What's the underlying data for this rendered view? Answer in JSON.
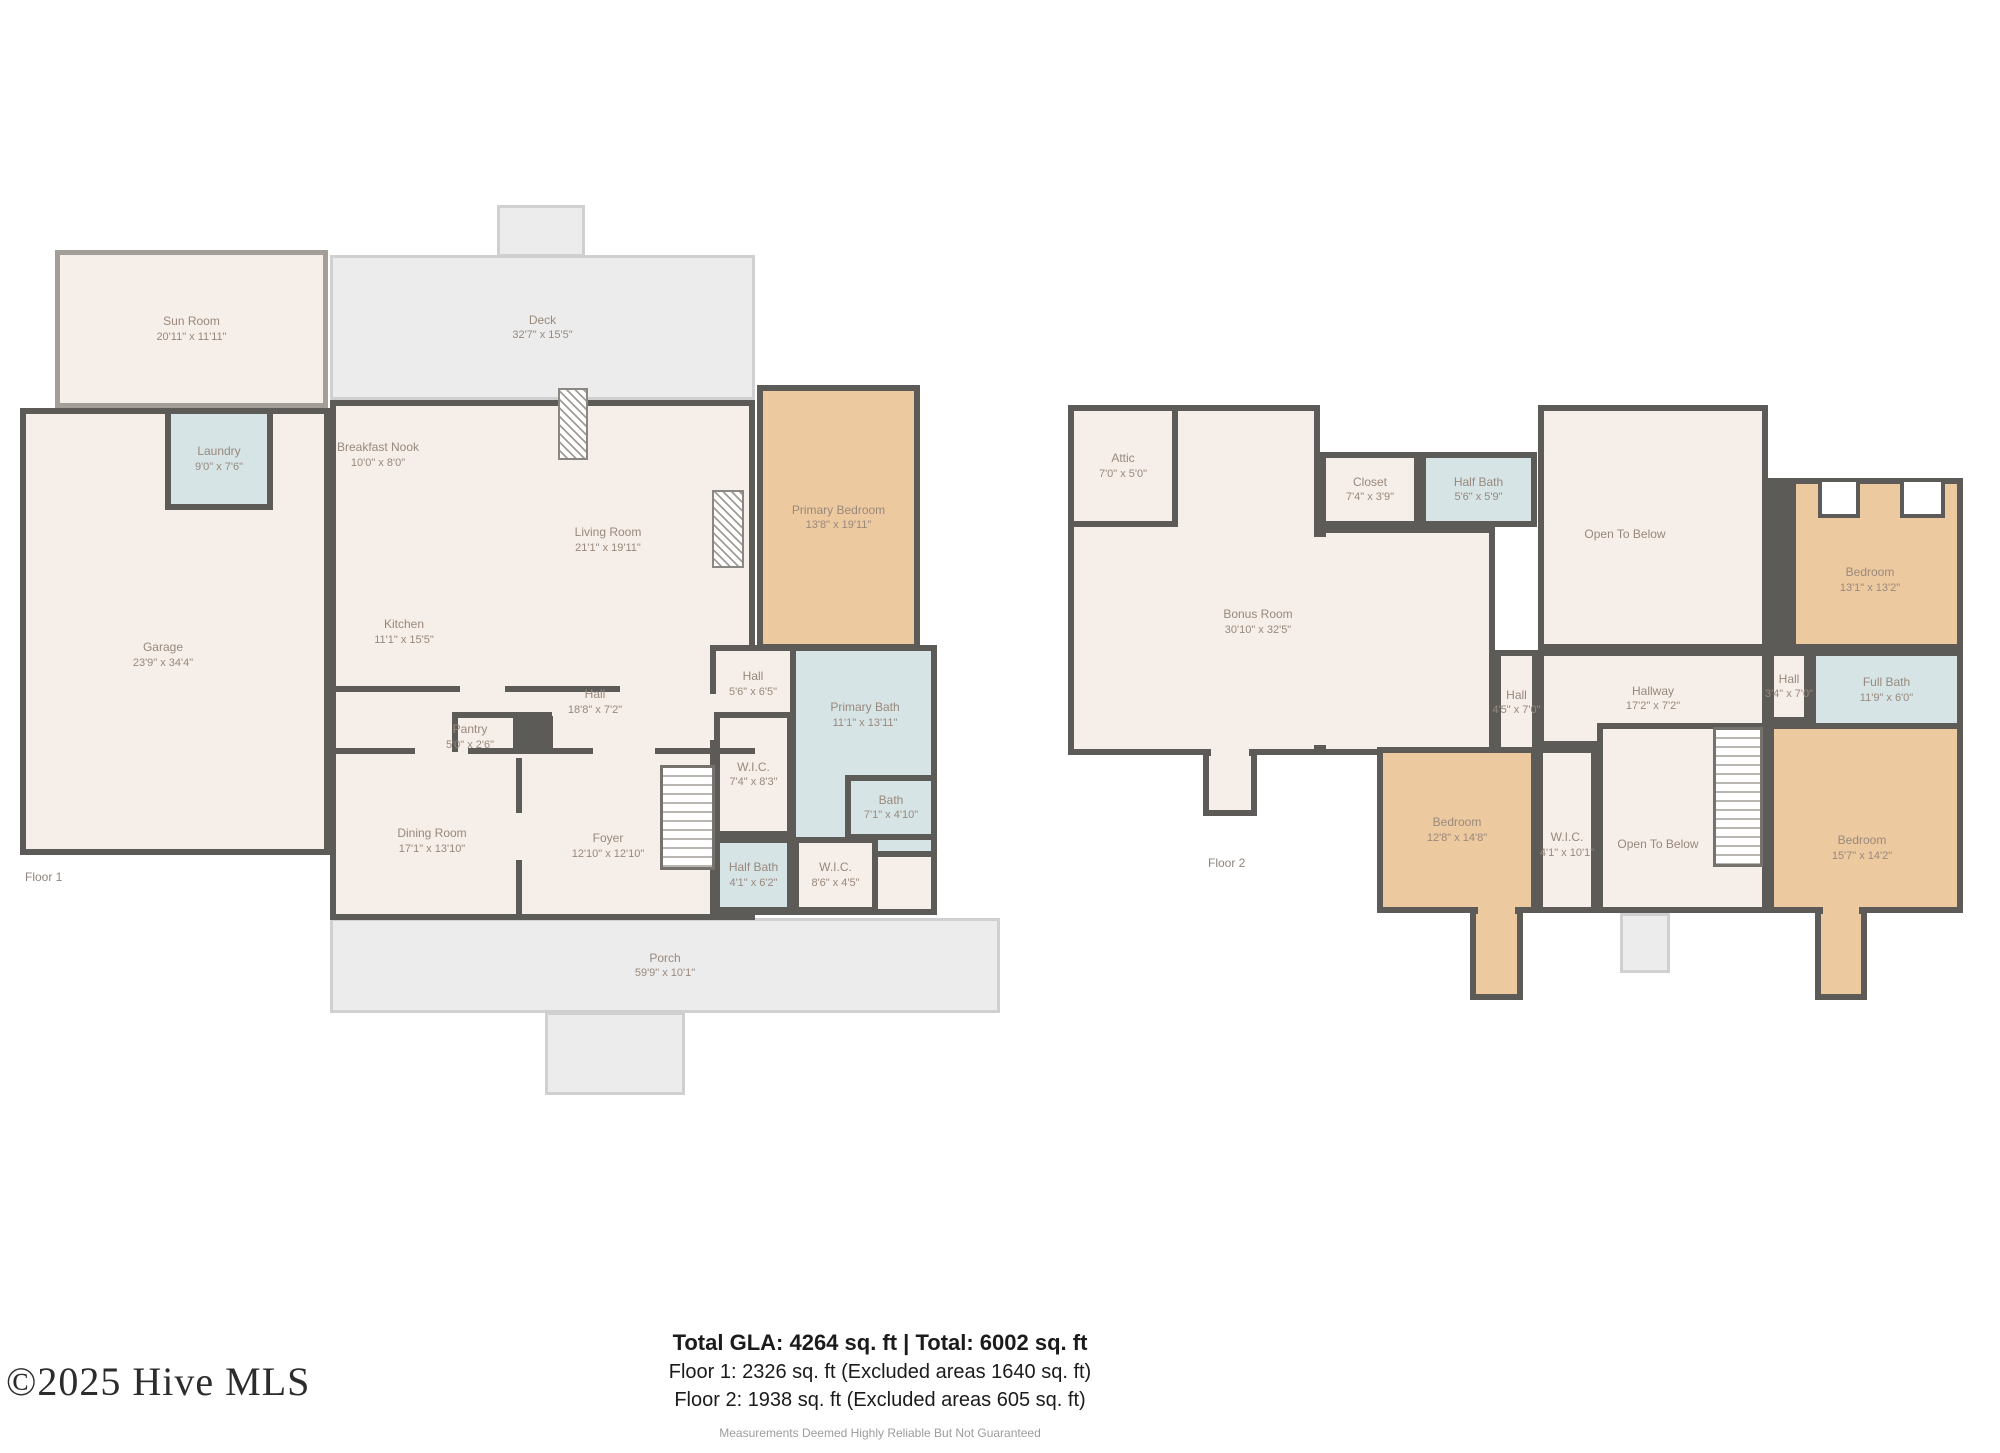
{
  "branding": {
    "copyright": "©2025 Hive MLS"
  },
  "summary": {
    "total": "Total GLA: 4264 sq. ft | Total: 6002 sq. ft",
    "floor1": "Floor 1: 2326 sq. ft (Excluded areas 1640 sq. ft)",
    "floor2": "Floor 2: 1938 sq. ft (Excluded areas 605 sq. ft)",
    "disclaimer": "Measurements Deemed Highly Reliable But Not Guaranteed"
  },
  "palette": {
    "wall": "#5d5b58",
    "room": "#f6eee9",
    "wet": "#d6e4e6",
    "accent": "#edc9a0",
    "outdoor_fill": "#ececec",
    "outdoor_line": "#d0d0d0",
    "label": "#99897c"
  },
  "floors": [
    {
      "tag": "Floor 1",
      "tag_pos": [
        25,
        870
      ],
      "elements": [
        {
          "kind": "outdoor",
          "name": "deck",
          "label": "Deck",
          "dims": "32'7\" x 15'5\"",
          "rect": [
            330,
            255,
            425,
            145
          ]
        },
        {
          "kind": "outdoor",
          "name": "deck-bump",
          "rect": [
            497,
            205,
            88,
            52
          ]
        },
        {
          "kind": "patch",
          "fill": "outdoor",
          "name": "deck-opening",
          "rect": [
            500,
            251,
            82,
            9
          ]
        },
        {
          "kind": "outdoor",
          "name": "porch",
          "label": "Porch",
          "dims": "59'9\" x 10'1\"",
          "rect": [
            330,
            918,
            670,
            95
          ]
        },
        {
          "kind": "outdoor",
          "name": "porch-steps",
          "rect": [
            545,
            1012,
            140,
            83
          ]
        },
        {
          "kind": "patch",
          "fill": "outdoor",
          "name": "porch-opening",
          "rect": [
            550,
            1008,
            130,
            9
          ]
        },
        {
          "kind": "sunroom",
          "name": "sun-room",
          "label": "Sun Room",
          "dims": "20'11\" x 11'11\"",
          "rect": [
            55,
            250,
            273,
            158
          ]
        },
        {
          "kind": "room",
          "fill": "room",
          "name": "garage",
          "label": "Garage",
          "dims": "23'9\" x 34'4\"",
          "rect": [
            20,
            408,
            310,
            447
          ],
          "labelAt": [
            163,
            655
          ]
        },
        {
          "kind": "room",
          "fill": "room",
          "name": "main-living-block",
          "rect": [
            330,
            400,
            425,
            520
          ]
        },
        {
          "kind": "room",
          "fill": "room",
          "name": "suite-wing",
          "rect": [
            710,
            645,
            227,
            270
          ]
        },
        {
          "kind": "patch",
          "fill": "room",
          "name": "hall-opening",
          "rect": [
            706,
            694,
            22,
            46
          ]
        },
        {
          "kind": "room",
          "fill": "wet",
          "name": "laundry",
          "label": "Laundry",
          "dims": "9'0\" x 7'6\"",
          "rect": [
            165,
            408,
            108,
            102
          ]
        },
        {
          "kind": "room",
          "fill": "accent",
          "name": "primary-bedroom",
          "label": "Primary Bedroom",
          "dims": "13'8\" x 19'11\"",
          "rect": [
            757,
            385,
            163,
            265
          ]
        },
        {
          "kind": "room",
          "fill": "wet",
          "name": "primary-bath",
          "label": "Primary Bath",
          "dims": "11'1\" x 13'11\"",
          "rect": [
            790,
            645,
            147,
            212
          ],
          "labelAt": [
            865,
            715
          ]
        },
        {
          "kind": "room",
          "fill": "room",
          "name": "wic-1",
          "label": "W.I.C.",
          "dims": "7'4\" x 8'3\"",
          "rect": [
            714,
            712,
            79,
            125
          ]
        },
        {
          "kind": "room",
          "fill": "wet",
          "name": "bath",
          "label": "Bath",
          "dims": "7'1\" x 4'10\"",
          "rect": [
            845,
            775,
            92,
            65
          ]
        },
        {
          "kind": "room",
          "fill": "wet",
          "name": "half-bath",
          "label": "Half Bath",
          "dims": "4'1\" x 6'2\"",
          "rect": [
            714,
            837,
            79,
            76
          ]
        },
        {
          "kind": "room",
          "fill": "room",
          "name": "wic-2",
          "label": "W.I.C.",
          "dims": "8'6\" x 4'5\"",
          "rect": [
            793,
            837,
            85,
            76
          ]
        },
        {
          "kind": "label",
          "name": "breakfast-nook",
          "label": "Breakfast Nook",
          "dims": "10'0\" x 8'0\"",
          "labelAt": [
            378,
            455
          ]
        },
        {
          "kind": "label",
          "name": "living-room",
          "label": "Living Room",
          "dims": "21'1\" x 19'11\"",
          "labelAt": [
            608,
            540
          ]
        },
        {
          "kind": "label",
          "name": "kitchen",
          "label": "Kitchen",
          "dims": "11'1\" x 15'5\"",
          "labelAt": [
            404,
            632
          ]
        },
        {
          "kind": "label",
          "name": "hall-main",
          "label": "Hall",
          "dims": "18'8\" x 7'2\"",
          "labelAt": [
            595,
            702
          ]
        },
        {
          "kind": "label",
          "name": "pantry",
          "label": "Pantry",
          "dims": "5'0\" x 2'6\"",
          "labelAt": [
            470,
            737
          ]
        },
        {
          "kind": "label",
          "name": "dining-room",
          "label": "Dining Room",
          "dims": "17'1\" x 13'10\"",
          "labelAt": [
            432,
            841
          ]
        },
        {
          "kind": "label",
          "name": "foyer",
          "label": "Foyer",
          "dims": "12'10\" x 12'10\"",
          "labelAt": [
            608,
            846
          ]
        },
        {
          "kind": "label",
          "name": "hall-suite",
          "label": "Hall",
          "dims": "5'6\" x 6'5\"",
          "labelAt": [
            753,
            684
          ]
        },
        {
          "kind": "wall",
          "name": "hall-wall",
          "rect": [
            330,
            686,
            130,
            6
          ]
        },
        {
          "kind": "wall",
          "name": "hall-wall",
          "rect": [
            505,
            686,
            115,
            6
          ]
        },
        {
          "kind": "wall",
          "name": "hall-wall",
          "rect": [
            330,
            748,
            85,
            6
          ]
        },
        {
          "kind": "wall",
          "name": "hall-wall",
          "rect": [
            468,
            748,
            125,
            6
          ]
        },
        {
          "kind": "wall",
          "name": "hall-wall",
          "rect": [
            655,
            748,
            100,
            6
          ]
        },
        {
          "kind": "wall",
          "name": "dining-foyer-wall",
          "rect": [
            516,
            758,
            6,
            55
          ]
        },
        {
          "kind": "wall",
          "name": "dining-foyer-wall",
          "rect": [
            516,
            860,
            6,
            58
          ]
        },
        {
          "kind": "wall",
          "name": "pantry-wall",
          "rect": [
            452,
            712,
            100,
            6
          ]
        },
        {
          "kind": "wall",
          "name": "pantry-wall",
          "rect": [
            452,
            712,
            6,
            40
          ]
        },
        {
          "kind": "chimney",
          "name": "chimney-block",
          "rect": [
            513,
            716,
            40,
            36
          ]
        },
        {
          "kind": "fireplace",
          "name": "fireplace",
          "rect": [
            712,
            490,
            32,
            78
          ]
        },
        {
          "kind": "fireplace",
          "name": "fireplace",
          "rect": [
            558,
            388,
            30,
            72
          ]
        },
        {
          "kind": "stairs",
          "name": "stairs-up",
          "rect": [
            660,
            765,
            55,
            105
          ]
        }
      ]
    },
    {
      "tag": "Floor 2",
      "tag_pos": [
        1208,
        856
      ],
      "elements": [
        {
          "kind": "room",
          "fill": "room",
          "name": "bonus-room",
          "rect": [
            1068,
            405,
            252,
            350
          ]
        },
        {
          "kind": "room",
          "fill": "room",
          "name": "bonus-room-ext",
          "rect": [
            1320,
            527,
            175,
            228
          ]
        },
        {
          "kind": "patch",
          "fill": "room",
          "name": "bonus-opening",
          "rect": [
            1310,
            537,
            22,
            208
          ]
        },
        {
          "kind": "label",
          "name": "bonus-room-label",
          "label": "Bonus Room",
          "dims": "30'10\" x 32'5\"",
          "labelAt": [
            1258,
            622
          ]
        },
        {
          "kind": "room",
          "fill": "room",
          "name": "attic",
          "label": "Attic",
          "dims": "7'0\" x 5'0\"",
          "rect": [
            1068,
            405,
            110,
            122
          ]
        },
        {
          "kind": "room",
          "fill": "room",
          "name": "closet",
          "label": "Closet",
          "dims": "7'4\" x 3'9\"",
          "rect": [
            1320,
            452,
            100,
            75
          ]
        },
        {
          "kind": "room",
          "fill": "wet",
          "name": "half-bath-f2",
          "label": "Half Bath",
          "dims": "5'6\" x 5'9\"",
          "rect": [
            1420,
            452,
            117,
            75
          ]
        },
        {
          "kind": "room",
          "fill": "room",
          "name": "open-to-below-upper",
          "label": "Open To Below",
          "rect": [
            1538,
            405,
            230,
            245
          ],
          "labelAt": [
            1625,
            535
          ]
        },
        {
          "kind": "wall",
          "name": "chase-wall",
          "rect": [
            1768,
            478,
            25,
            172
          ]
        },
        {
          "kind": "room",
          "fill": "accent",
          "name": "bedroom-1",
          "label": "Bedroom",
          "dims": "13'1\" x 13'2\"",
          "rect": [
            1790,
            478,
            173,
            172
          ],
          "labelAt": [
            1870,
            580
          ]
        },
        {
          "kind": "cutout",
          "name": "closet-nook",
          "rect": [
            1818,
            478,
            42,
            40
          ]
        },
        {
          "kind": "cutout",
          "name": "closet-nook",
          "rect": [
            1900,
            478,
            45,
            40
          ]
        },
        {
          "kind": "room",
          "fill": "room",
          "name": "hallway",
          "label": "Hallway",
          "dims": "17'2\" x 7'2\"",
          "rect": [
            1538,
            650,
            230,
            97
          ]
        },
        {
          "kind": "room",
          "fill": "room",
          "name": "hall-a",
          "label": "Hall",
          "dims": "4'5\" x 7'0\"",
          "rect": [
            1495,
            650,
            43,
            105
          ]
        },
        {
          "kind": "room",
          "fill": "room",
          "name": "hall-b",
          "label": "Hall",
          "dims": "3'4\" x 7'0\"",
          "rect": [
            1768,
            650,
            42,
            73
          ]
        },
        {
          "kind": "room",
          "fill": "wet",
          "name": "full-bath",
          "label": "Full Bath",
          "dims": "11'9\" x 6'0\"",
          "rect": [
            1810,
            650,
            153,
            80
          ]
        },
        {
          "kind": "room",
          "fill": "accent",
          "name": "bedroom-2",
          "label": "Bedroom",
          "dims": "12'8\" x 14'8\"",
          "rect": [
            1377,
            747,
            160,
            166
          ]
        },
        {
          "kind": "room",
          "fill": "accent",
          "name": "bedroom-2-nook",
          "rect": [
            1470,
            908,
            53,
            92
          ]
        },
        {
          "kind": "patch",
          "fill": "accent",
          "name": "bedroom-2-opening",
          "rect": [
            1478,
            901,
            37,
            18
          ]
        },
        {
          "kind": "room",
          "fill": "room",
          "name": "wic-f2",
          "label": "W.I.C.",
          "dims": "4'1\" x 10'1\"",
          "rect": [
            1537,
            747,
            60,
            166
          ],
          "labelAt": [
            1567,
            845
          ]
        },
        {
          "kind": "room",
          "fill": "room",
          "name": "open-to-below-lower",
          "label": "Open To Below",
          "rect": [
            1597,
            723,
            171,
            190
          ],
          "labelAt": [
            1658,
            845
          ]
        },
        {
          "kind": "stairs",
          "name": "stairs-down",
          "rect": [
            1713,
            727,
            50,
            140
          ]
        },
        {
          "kind": "room",
          "fill": "accent",
          "name": "bedroom-3",
          "label": "Bedroom",
          "dims": "15'7\" x 14'2\"",
          "rect": [
            1768,
            723,
            195,
            190
          ],
          "labelAt": [
            1862,
            848
          ]
        },
        {
          "kind": "room",
          "fill": "accent",
          "name": "bedroom-3-nook",
          "rect": [
            1815,
            908,
            52,
            92
          ]
        },
        {
          "kind": "patch",
          "fill": "accent",
          "name": "bedroom-3-opening",
          "rect": [
            1823,
            901,
            36,
            18
          ]
        },
        {
          "kind": "room",
          "fill": "room",
          "name": "bonus-landing",
          "rect": [
            1203,
            750,
            54,
            66
          ]
        },
        {
          "kind": "patch",
          "fill": "room",
          "name": "landing-opening",
          "rect": [
            1211,
            744,
            38,
            16
          ]
        },
        {
          "kind": "outdoor",
          "name": "stoop",
          "rect": [
            1620,
            913,
            50,
            60
          ]
        }
      ]
    }
  ]
}
